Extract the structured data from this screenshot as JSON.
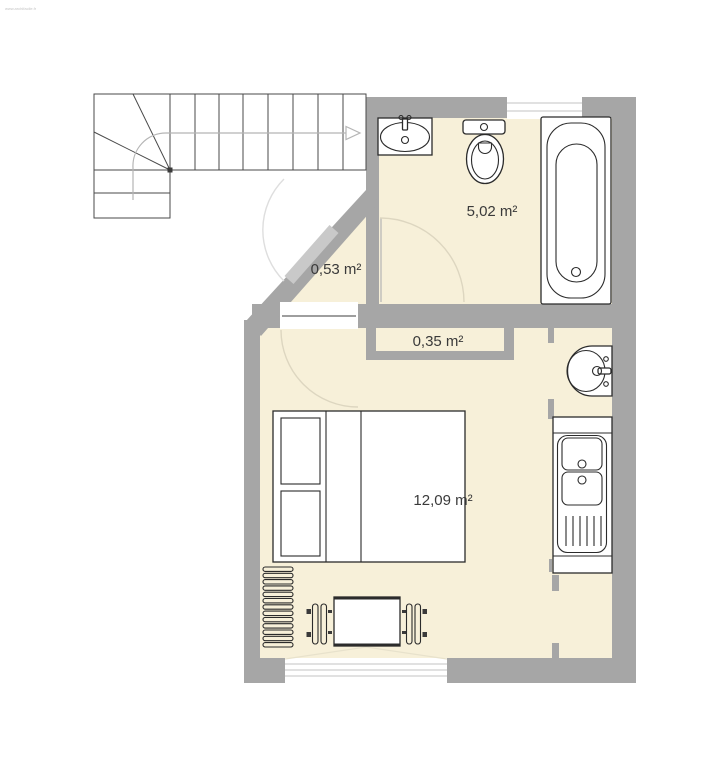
{
  "watermark": "www.archifacile.fr",
  "rooms": {
    "bathroom": {
      "area_label": "5,02 m²"
    },
    "entry": {
      "area_label": "0,53 m²"
    },
    "closet": {
      "area_label": "0,35 m²"
    },
    "bedroom": {
      "area_label": "12,09 m²"
    }
  },
  "colors": {
    "wall": "#a6a6a6",
    "floor": "#f7f0d9",
    "door_leaf": "#c9c9c9",
    "furniture_outline": "#2b2b2b"
  },
  "fixtures": [
    "staircase",
    "bathroom-sink",
    "toilet",
    "bathtub",
    "entry-door",
    "bathroom-door",
    "bedroom-door",
    "wall-niche",
    "washbasin",
    "kitchen-sink-unit",
    "bed",
    "radiator",
    "table",
    "chair-left",
    "chair-right",
    "window-top",
    "window-bottom"
  ]
}
